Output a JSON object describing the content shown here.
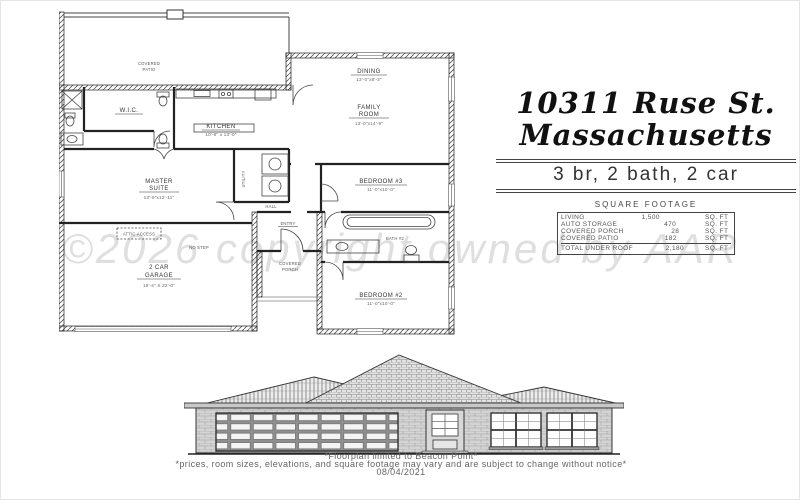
{
  "title_block": {
    "address_line1": "10311 Ruse St.",
    "address_line2": "Massachusetts",
    "summary": "3 br, 2 bath, 2 car",
    "sqft_title": "SQUARE FOOTAGE",
    "table": {
      "rows": [
        {
          "label": "LIVING",
          "value": "1,500",
          "unit": "SQ. FT"
        },
        {
          "label": "AUTO STORAGE",
          "value": "470",
          "unit": "SQ. FT"
        },
        {
          "label": "COVERED PORCH",
          "value": "28",
          "unit": "SQ. FT"
        },
        {
          "label": "COVERED PATIO",
          "value": "182",
          "unit": "SQ. FT"
        }
      ],
      "total": {
        "label": "TOTAL UNDER ROOF",
        "value": "2,180",
        "unit": "SQ. FT"
      }
    }
  },
  "floorplan": {
    "labels": {
      "covered_patio_1": "COVERED",
      "covered_patio_2": "PATIO",
      "wic": "W.I.C.",
      "kitchen": "KITCHEN",
      "kitchen_dims": "10'-8\" x 13'-0\"",
      "master_1": "MASTER",
      "master_2": "SUITE",
      "master_dims": "13'-9\"x12'-11\"",
      "dining": "DINING",
      "dining_dims": "13'-0\"x8'-3\"",
      "family_1": "FAMILY",
      "family_2": "ROOM",
      "family_dims": "13'-0\"x14'-9\"",
      "bed3": "BEDROOM #3",
      "bed3_dims": "11'-0\"x10'-0\"",
      "bath2": "BATH #2",
      "bed2": "BEDROOM #2",
      "bed2_dims": "11'-0\"x10'-0\"",
      "utility": "UTILITY",
      "hall": "HALL",
      "entry": "ENTRY",
      "porch_1": "COVERED",
      "porch_2": "PORCH",
      "garage_1": "2 CAR",
      "garage_2": "GARAGE",
      "garage_dims": "19'-4\" X 22'-0\"",
      "attic": "ATTIC ACCESS",
      "no_step": "NO STEP"
    }
  },
  "watermark": "©2026 copyright owned by AAR",
  "footer": {
    "line1": "*Floorplan limited to Beacon Point*",
    "line2": "*prices, room sizes, elevations, and square footage may vary and are subject to change without notice*",
    "date": "08/04/2021"
  }
}
